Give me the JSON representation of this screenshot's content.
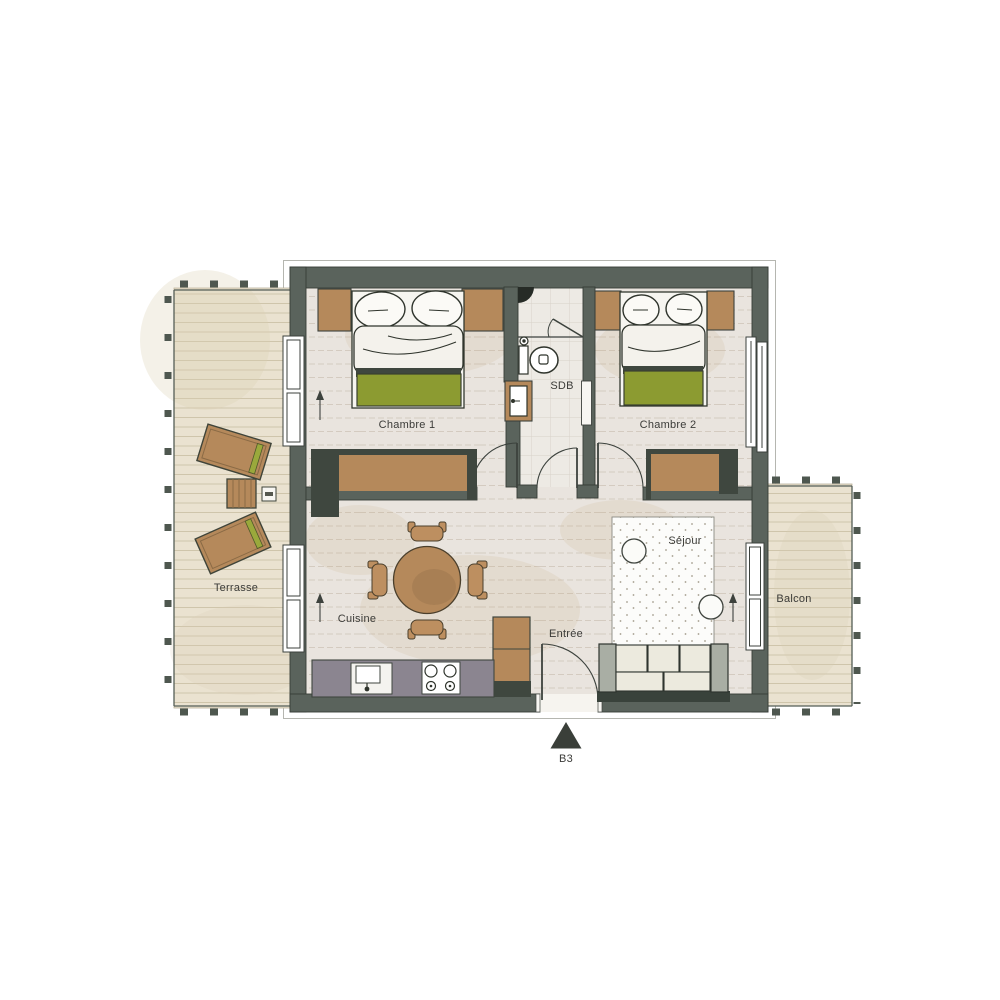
{
  "plan": {
    "unit_label": "B3",
    "rooms": [
      {
        "id": "chambre-1",
        "label": "Chambre 1"
      },
      {
        "id": "chambre-2",
        "label": "Chambre 2"
      },
      {
        "id": "sdb",
        "label": "SDB"
      },
      {
        "id": "cuisine",
        "label": "Cuisine"
      },
      {
        "id": "entree",
        "label": "Entrée"
      },
      {
        "id": "sejour",
        "label": "Séjour"
      },
      {
        "id": "terrasse",
        "label": "Terrasse"
      },
      {
        "id": "balcon",
        "label": "Balcon"
      }
    ],
    "palette": {
      "wall": "#5a635c",
      "interior_floor": "#e9e4de",
      "deck_floor": "#eae2d0",
      "tile_floor": "#edeae4",
      "wood_accent": "#b5895b",
      "green_accent": "#8c9b31",
      "kitchen_counter": "#8b8590",
      "marker_dark": "#3a3f39"
    }
  }
}
